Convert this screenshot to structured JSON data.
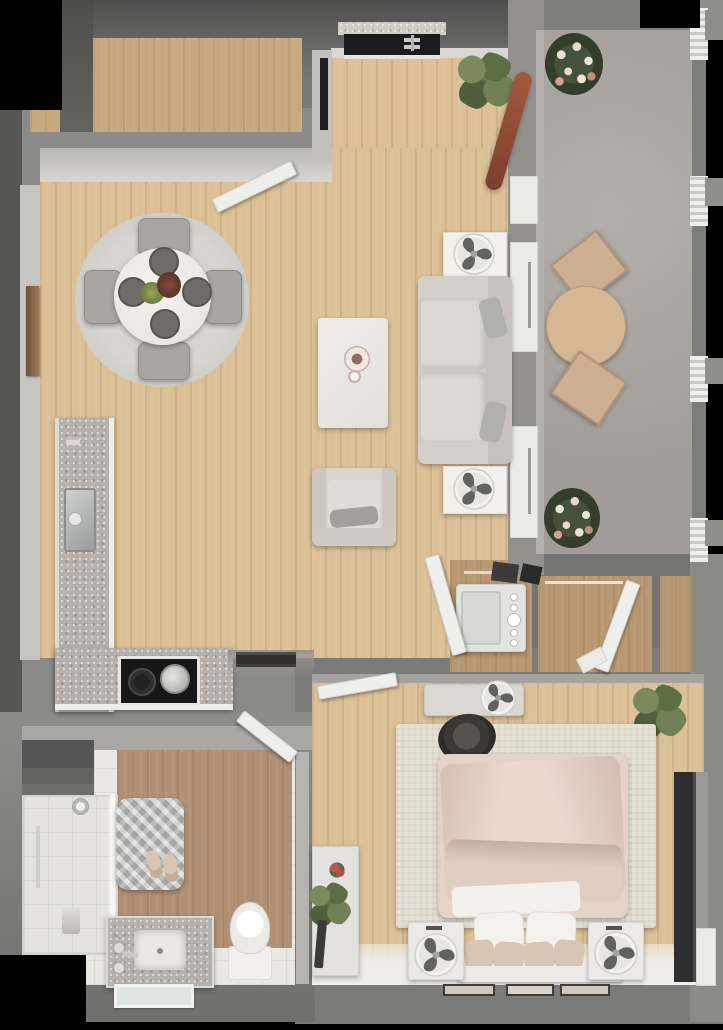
{
  "meta": {
    "type": "3d-floor-plan-render",
    "view": "top-down",
    "description": "Photorealistic top-down 3D render of a one-bedroom apartment with balcony",
    "text_visible": false
  },
  "palette": {
    "background": "#000000",
    "wall_dark": "#5e5e5c",
    "wall_mid": "#7d7d7b",
    "wall_light": "#a9a8a5",
    "wall_face": "#cfceca",
    "floor_wood_main": "#dcc096",
    "floor_wood_hall": "#c8a87e",
    "floor_wood_closet": "#b89871",
    "floor_wood_bath": "#b09176",
    "floor_tile": "#e9e8e4",
    "floor_concrete": "#aba6a0",
    "granite": "#b6b2ab",
    "white_furniture": "#f0efec",
    "upholstery_gray": "#d6d2cb",
    "chair_gray": "#a9a6a1",
    "bed_duvet": "#e5d3c8",
    "bed_rug": "#e7e1d5",
    "bath_rug": "#c6c6c4",
    "stove": "#161616",
    "tv": "#2e2e30",
    "patio_wood": "#d3b394",
    "plant_green": "#5f7048",
    "frame_dark": "#3f3b37",
    "metal": "#c9c9c7"
  },
  "rooms": [
    {
      "id": "entry-hall",
      "label": "Entry hall",
      "floor": "wood",
      "items": [
        "hall-door"
      ]
    },
    {
      "id": "dining-area",
      "label": "Dining area",
      "floor": "wood",
      "items": [
        "round rug",
        "round dining table",
        "4 tufted chairs",
        "4 place settings",
        "floral centerpiece",
        "wall art"
      ]
    },
    {
      "id": "kitchen",
      "label": "Kitchen",
      "floor": "wood",
      "items": [
        "L-shaped granite counter",
        "sink",
        "2 faucets",
        "cooktop with pot",
        "serving tray"
      ]
    },
    {
      "id": "living-room",
      "label": "Living room",
      "floor": "wood",
      "items": [
        "sofa with 2 pillows",
        "coffee table with vases",
        "armchair",
        "2 side tables",
        "2 table fans",
        "wall TV",
        "corner plant",
        "surfboard",
        "entry niche"
      ]
    },
    {
      "id": "balcony",
      "label": "Balcony",
      "floor": "concrete",
      "items": [
        "round patio table",
        "2 patio chairs",
        "2 flowering plants",
        "railing sections"
      ]
    },
    {
      "id": "laundry-closet",
      "label": "Laundry closet",
      "floor": "wood",
      "items": [
        "washing machine",
        "shelf items",
        "louvered door"
      ]
    },
    {
      "id": "walk-in-closet",
      "label": "Walk-in closet",
      "floor": "wood",
      "items": [
        "clothes rod",
        "closet door"
      ]
    },
    {
      "id": "storage-closet",
      "label": "Storage closet",
      "floor": "wood",
      "items": []
    },
    {
      "id": "bedroom",
      "label": "Bedroom",
      "floor": "wood",
      "items": [
        "double bed with blush duvet",
        "6 pillows",
        "headboard",
        "2 nightstands",
        "2 table fans",
        "cream area rug",
        "sun hat",
        "bench with fan",
        "dresser with plant",
        "potted plant",
        "wall TV",
        "3 picture frames",
        "bedroom door"
      ]
    },
    {
      "id": "bathroom",
      "label": "Bathroom",
      "floor": "wood and tile",
      "items": [
        "walk-in shower",
        "shower head",
        "knit bath mat",
        "slippers",
        "granite vanity with sink",
        "faucet handles",
        "mirror",
        "toilet",
        "linen niche",
        "bathroom door"
      ]
    }
  ]
}
